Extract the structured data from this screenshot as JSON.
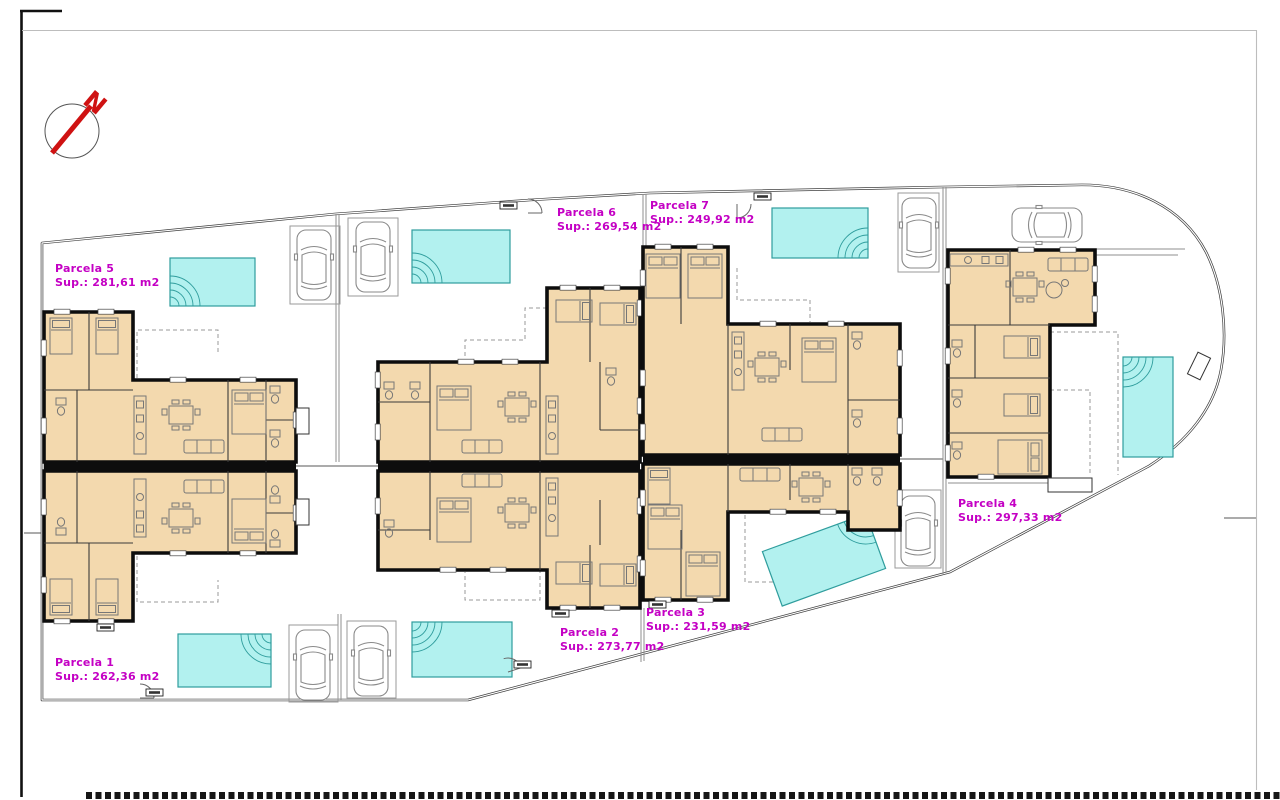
{
  "sheet": {
    "kind": "residential development site plan"
  },
  "compass": {
    "label": "N"
  },
  "parcels": [
    {
      "name": "Parcela 1",
      "sup": "Sup.: 262,36 m2"
    },
    {
      "name": "Parcela 2",
      "sup": "Sup.: 273,77 m2"
    },
    {
      "name": "Parcela 3",
      "sup": "Sup.: 231,59 m2"
    },
    {
      "name": "Parcela 4",
      "sup": "Sup.: 297,33 m2"
    },
    {
      "name": "Parcela 5",
      "sup": "Sup.: 281,61 m2"
    },
    {
      "name": "Parcela 6",
      "sup": "Sup.: 269,54 m2"
    },
    {
      "name": "Parcela 7",
      "sup": "Sup.: 249,92 m2"
    }
  ],
  "colors": {
    "floor": "#f3d9ae",
    "wall": "#0d0d0d",
    "pool": "#b2f1ef",
    "pool_border": "#2f9d9d",
    "parcel_label": "#c400c4",
    "north_arrow": "#cf1212",
    "boundary": "#3f3f3f"
  }
}
